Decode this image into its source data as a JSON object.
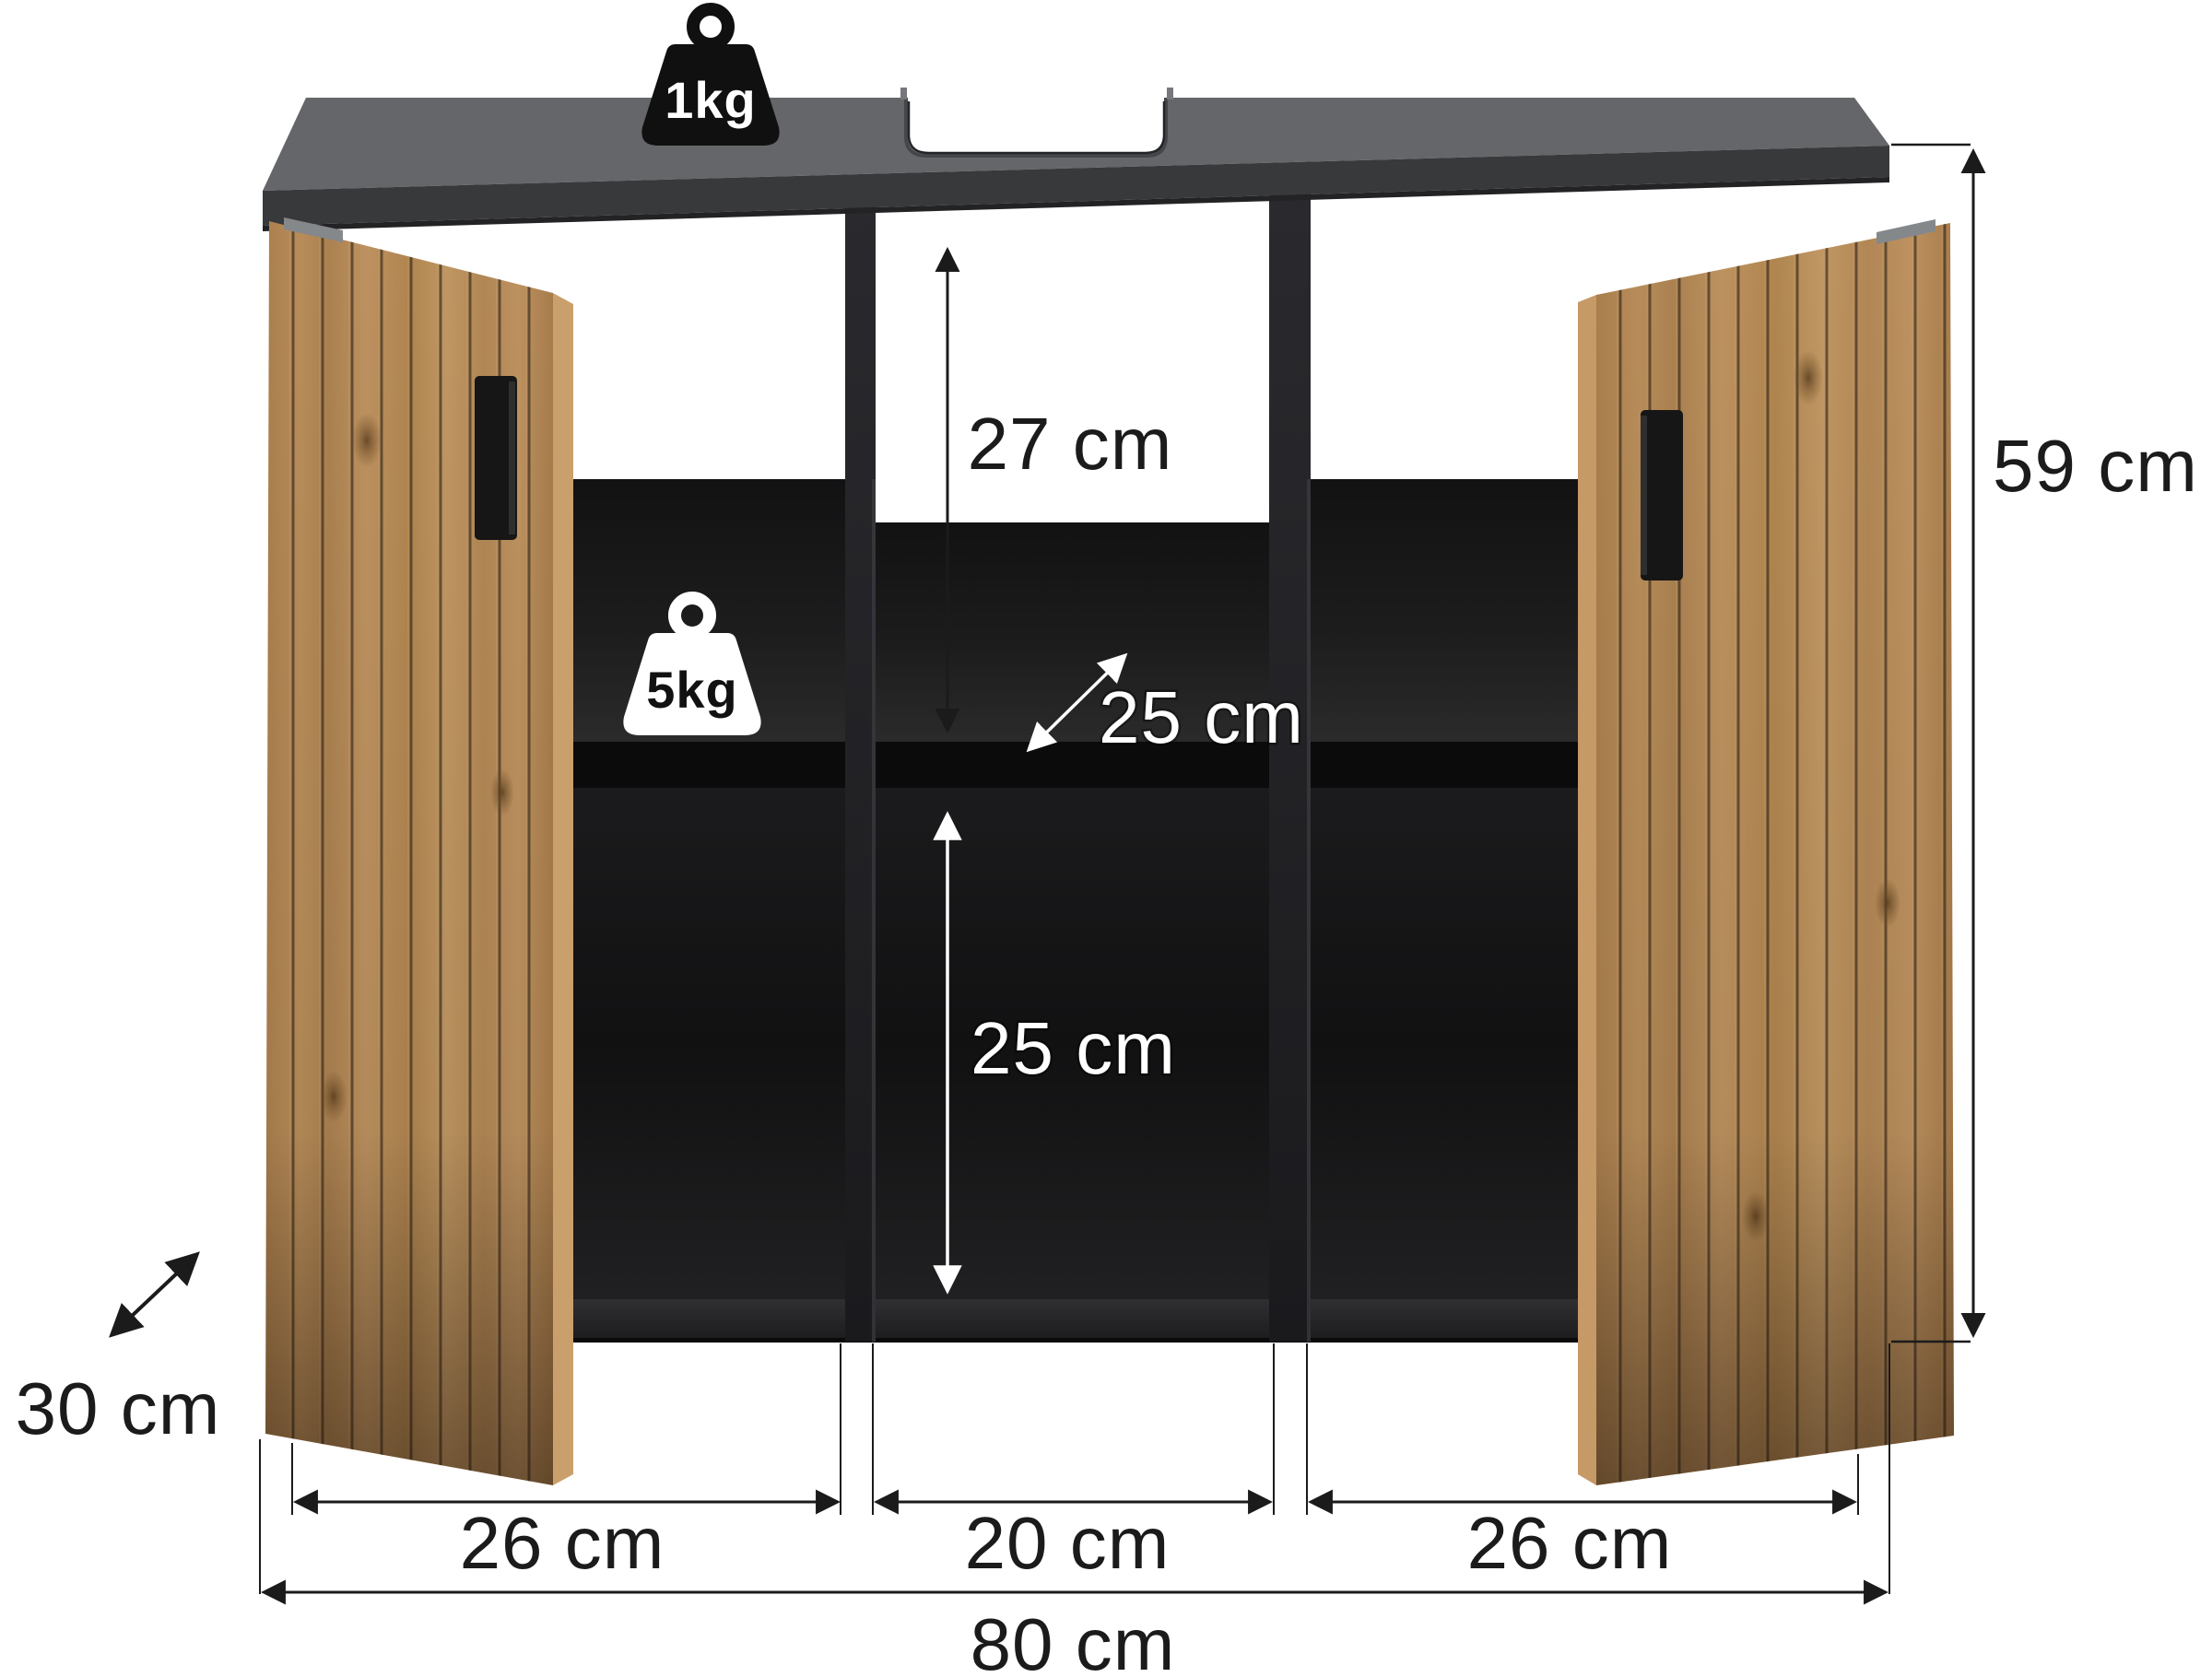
{
  "diagram": {
    "type": "product-dimension-diagram",
    "subject": "bathroom sink vanity cabinet with two slatted wood doors",
    "loads": {
      "top_load": "1kg",
      "shelf_load": "5kg"
    },
    "dimensions": {
      "total_height": "59 cm",
      "depth": "30 cm",
      "top_compartment_height": "27 cm",
      "shelf_depth": "25 cm",
      "bottom_compartment_height": "25 cm",
      "left_compartment_width": "26 cm",
      "middle_compartment_width": "20 cm",
      "right_compartment_width": "26 cm",
      "total_width": "80 cm"
    },
    "colors": {
      "background": "#ffffff",
      "top_panel": "#656669",
      "top_panel_front": "#38393b",
      "interior_dark": "#161617",
      "wood": "#b78c59",
      "handle": "#161616",
      "dimension_line": "#1b1b1b",
      "light_label": "#ffffff"
    }
  }
}
